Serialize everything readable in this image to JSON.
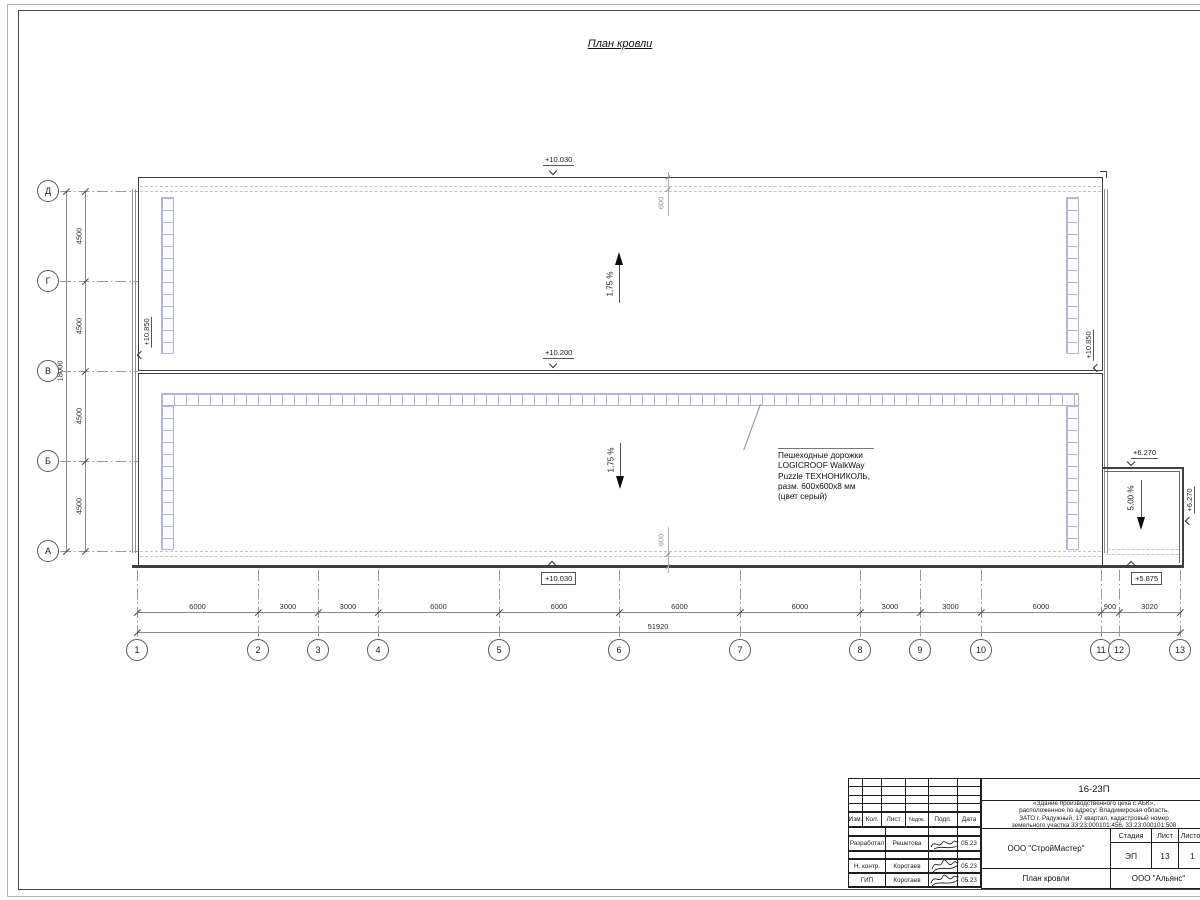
{
  "page": {
    "title": "План кровли"
  },
  "axes": {
    "rows": [
      "Д",
      "Г",
      "В",
      "Б",
      "А"
    ],
    "row_dims": [
      "4500",
      "4500",
      "4500",
      "4500"
    ],
    "row_total": "18000",
    "cols": [
      "1",
      "2",
      "3",
      "4",
      "5",
      "6",
      "7",
      "8",
      "9",
      "10",
      "11",
      "12",
      "13"
    ],
    "col_dims": [
      "6000",
      "3000",
      "3000",
      "6000",
      "6000",
      "6000",
      "6000",
      "3000",
      "3000",
      "6000",
      "900",
      "3020"
    ],
    "col_total": "51920"
  },
  "elevations": {
    "top": "+10.030",
    "ridge": "+10.200",
    "bottom": "+10.030",
    "parapet_left": "+10.850",
    "parapet_right": "+10.850",
    "annex_top": "+6.270",
    "annex_right": "+6.270",
    "annex_bottom": "+5.875"
  },
  "slopes": {
    "upper": "1,75 %",
    "lower": "1,75 %",
    "annex": "5,00 %"
  },
  "walkway": {
    "dim": "600",
    "note": [
      "Пешеходные дорожки",
      "LOGICROOF WalkWay",
      "Puzzle ТЕХНОНИКОЛЬ,",
      "разм. 600х600х8 мм",
      "(цвет серый)"
    ]
  },
  "title_block": {
    "doc_number": "16-23П",
    "description": [
      "«Здание производственного цеха с АБК»,",
      "расположенное по адресу: Владимирская область,",
      "ЗАТО г. Радужный, 17 квартал, кадастровый номер",
      "земельного участка 33:23:000101:456, 33:23:000101:508"
    ],
    "columns": [
      "Изм.",
      "Кол.",
      "Лист",
      "№док.",
      "Подп.",
      "Дата"
    ],
    "org": "ООО \"СтройМастер\"",
    "stage_label": "Стадия",
    "sheet_label": "Лист",
    "sheets_label": "Листов",
    "stage": "ЭП",
    "sheet": "13",
    "sheets": "1",
    "sheet_title": "План кровли",
    "org2": "ООО \"Альянс\"",
    "roles": [
      {
        "role": "Разработал",
        "name": "Решетова",
        "date": "05.23"
      },
      {
        "role": "Н. контр.",
        "name": "Коротаев",
        "date": "05.23"
      },
      {
        "role": "ГИП",
        "name": "Коротаев",
        "date": "05.23"
      }
    ]
  },
  "colors": {
    "walkway_tile": "#b4b4e2",
    "outline": "#3f3f3f",
    "dim_line": "#8a8a8a",
    "wall": "#8e8e8e"
  }
}
